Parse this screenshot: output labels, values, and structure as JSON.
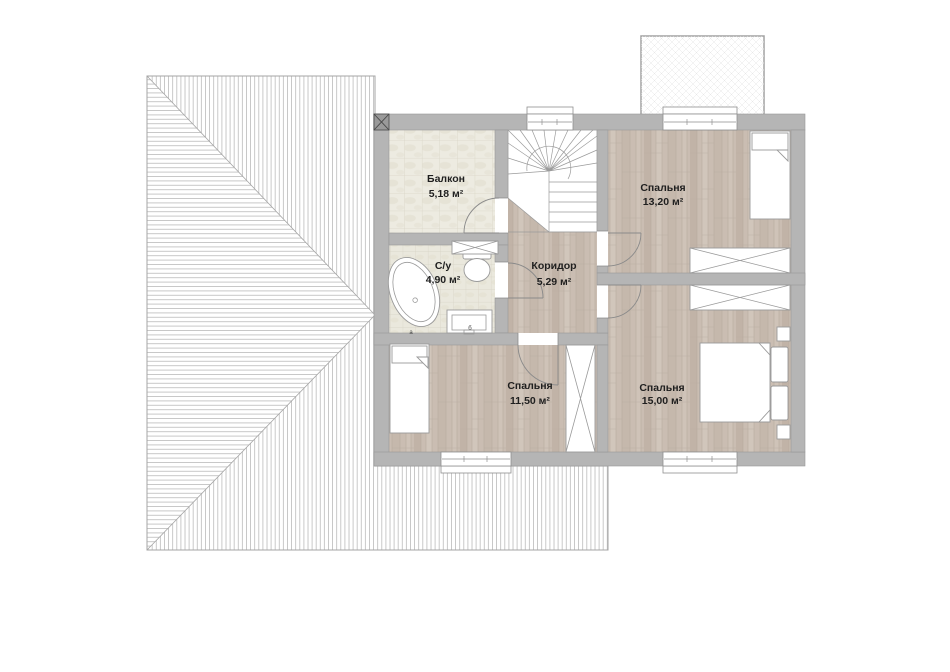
{
  "plan": {
    "type": "floor-plan",
    "floor_labels_language": "ru"
  },
  "rooms": [
    {
      "id": "balcony",
      "label": "Балкон",
      "area": "5,18 м²",
      "floor": "tile"
    },
    {
      "id": "bathroom",
      "label": "С/у",
      "area": "4,90 м²",
      "floor": "tile"
    },
    {
      "id": "corridor",
      "label": "Коридор",
      "area": "5,29 м²",
      "floor": "wood"
    },
    {
      "id": "bedroom-top-right",
      "label": "Спальня",
      "area": "13,20 м²",
      "floor": "wood"
    },
    {
      "id": "bedroom-bottom-left",
      "label": "Спальня",
      "area": "11,50 м²",
      "floor": "wood"
    },
    {
      "id": "bedroom-bottom-right",
      "label": "Спальня",
      "area": "15,00 м²",
      "floor": "wood"
    }
  ],
  "fixture_marks": {
    "bathtub": "а",
    "sink": "б"
  },
  "colors": {
    "wall": "#b5b5b5",
    "wall_marker": "#9a9a9a",
    "roof_outline": "#a5a5a5",
    "hatch_line": "#ababab",
    "wood_floor": "#cabdb2",
    "tile_floor": "#edebe1",
    "label_text": "#1f1f1f"
  }
}
